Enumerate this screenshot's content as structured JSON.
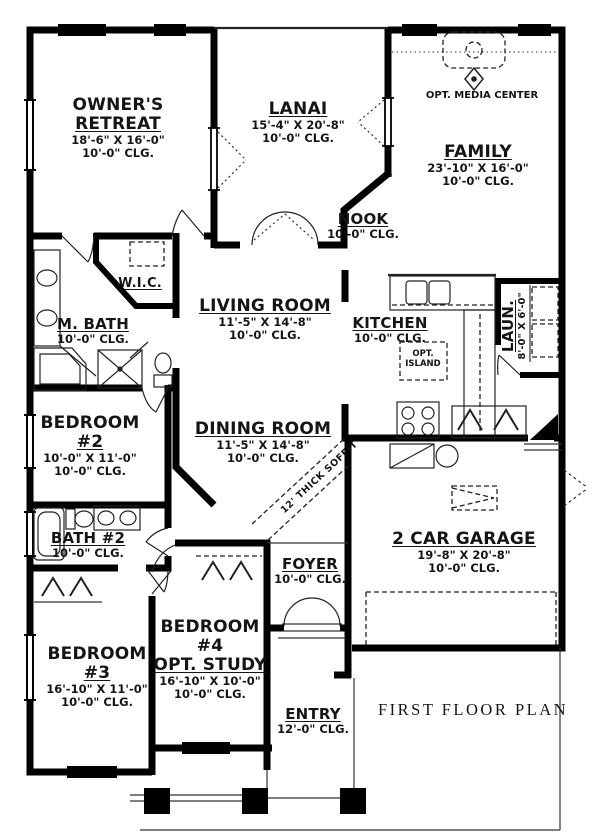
{
  "title": {
    "text": "FIRST FLOOR PLAN"
  },
  "rooms": {
    "owners_retreat": {
      "line1": "OWNER'S",
      "line2": "RETREAT",
      "dims": "18'-6\" X 16'-0\"",
      "clg": "10'-0\" CLG."
    },
    "lanai": {
      "line1": "LANAI",
      "dims": "15'-4\" X 20'-8\"",
      "clg": "10'-0\" CLG."
    },
    "family": {
      "line1": "FAMILY",
      "dims": "23'-10\" X 16'-0\"",
      "clg": "10'-0\" CLG."
    },
    "nook": {
      "line1": "NOOK",
      "clg": "10'-0\" CLG."
    },
    "wic": {
      "line1": "W.I.C."
    },
    "m_bath": {
      "line1": "M. BATH",
      "clg": "10'-0\" CLG."
    },
    "living_room": {
      "line1": "LIVING ROOM",
      "dims": "11'-5\" X 14'-8\"",
      "clg": "10'-0\" CLG."
    },
    "kitchen": {
      "line1": "KITCHEN",
      "clg": "10'-0\" CLG."
    },
    "dining_room": {
      "line1": "DINING ROOM",
      "dims": "11'-5\" X 14'-8\"",
      "clg": "10'-0\" CLG."
    },
    "laundry": {
      "line1": "LAUN.",
      "dims": "8'-0\" X 6'-0\""
    },
    "bedroom2": {
      "line1": "BEDROOM",
      "line2": "#2",
      "dims": "10'-0\" X 11'-0\"",
      "clg": "10'-0\" CLG."
    },
    "bath2": {
      "line1": "BATH #2",
      "clg": "10'-0\" CLG."
    },
    "garage": {
      "line1": "2 CAR GARAGE",
      "dims": "19'-8\" X 20'-8\"",
      "clg": "10'-0\" CLG."
    },
    "foyer": {
      "line1": "FOYER",
      "clg": "10'-0\" CLG."
    },
    "bedroom3": {
      "line1": "BEDROOM",
      "line2": "#3",
      "dims": "16'-10\" X 11'-0\"",
      "clg": "10'-0\" CLG."
    },
    "bedroom4": {
      "line1": "BEDROOM",
      "line2": "#4",
      "line3": "OPT. STUDY",
      "dims": "16'-10\" X 10'-0\"",
      "clg": "10'-0\" CLG."
    },
    "entry": {
      "line1": "ENTRY",
      "clg": "12'-0\" CLG."
    }
  },
  "annotations": {
    "opt_media_center": "OPT. MEDIA CENTER",
    "opt_island_line1": "OPT.",
    "opt_island_line2": "ISLAND",
    "soffit": "12' THICK SOFFIT"
  },
  "colors": {
    "wall": "#000000",
    "ink": "#151515",
    "background": "#ffffff"
  }
}
